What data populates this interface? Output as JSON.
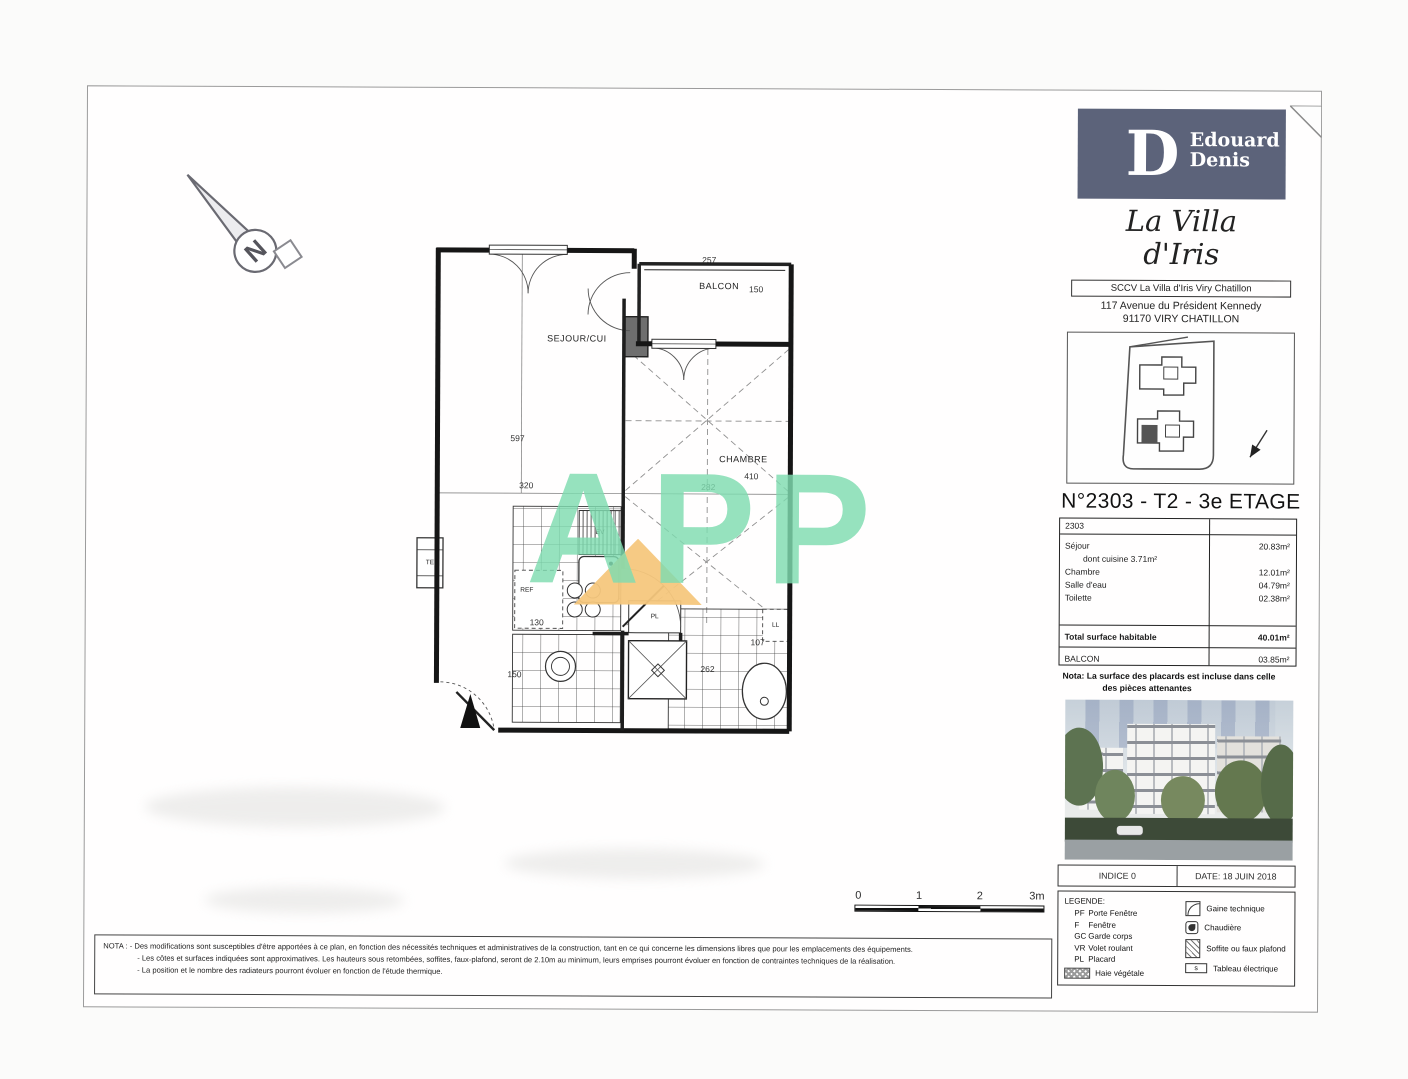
{
  "colors": {
    "brand": "#5c637a",
    "wm_green": "#7fdcb0",
    "wm_orange": "#f6c77d"
  },
  "north": {
    "label": "N"
  },
  "plan": {
    "rooms": {
      "sejour": "SEJOUR/CUI",
      "balcon": "BALCON",
      "chambre": "CHAMBRE"
    },
    "fixtures": {
      "te": "TE",
      "ev": "EV",
      "ref": "REF",
      "pl": "PL",
      "ll": "LL"
    },
    "dims": {
      "balcon_w": "257",
      "balcon_d": "150",
      "sejour_h": "597",
      "sejour_w": "320",
      "chambre_h": "410",
      "chambre_w": "282",
      "kitchen_w": "130",
      "entry_w": "150",
      "bath_w": "262",
      "bath_d": "107"
    }
  },
  "watermark": {
    "text": "APP"
  },
  "scalebar": {
    "ticks": [
      "0",
      "1",
      "2",
      "3m"
    ]
  },
  "nota_bottom": {
    "line1": "NOTA : - Des modifications sont susceptibles d'être apportées à ce plan, en fonction des nécessités techniques et administratives de la construction, tant en ce qui concerne les dimensions libres que pour les emplacements des équipements.",
    "line2": "- Les côtes et surfaces indiquées sont approximatives. Les hauteurs sous retombées, soffites, faux-plafond, seront de 2.10m au minimum, leurs emprises pourront évoluer en fonction de contraintes techniques de la réalisation.",
    "line3": "- La position et le nombre des radiateurs pourront évoluer en fonction de l'étude thermique."
  },
  "titleblock": {
    "logo": {
      "initial": "D",
      "brand_line1": "Edouard",
      "brand_line2": "Denis"
    },
    "project": {
      "line1": "La Villa",
      "line2": "d'Iris"
    },
    "company": "SCCV La Villa d'Iris Viry Chatillon",
    "address1": "117 Avenue du Président Kennedy",
    "address2": "91170 VIRY CHATILLON",
    "unit_title": "N°2303 - T2 - 3e ETAGE",
    "table": {
      "unit": "2303",
      "rows": [
        {
          "label": "Séjour",
          "value": "20.83m²"
        },
        {
          "label": "dont cuisine 3.71m²",
          "value": ""
        },
        {
          "label": "Chambre",
          "value": "12.01m²"
        },
        {
          "label": "Salle d'eau",
          "value": "04.79m²"
        },
        {
          "label": "Toilette",
          "value": "02.38m²"
        }
      ],
      "total_label": "Total surface habitable",
      "total_value": "40.01m²",
      "balcony_label": "BALCON",
      "balcony_value": "03.85m²"
    },
    "nota_line1": "Nota: La surface des placards est incluse dans celle",
    "nota_line2": "des pièces attenantes",
    "indice": "INDICE 0",
    "date": "DATE: 18 JUIN 2018",
    "legend": {
      "title": "LEGENDE:",
      "abbrevs": [
        {
          "abbr": "PF",
          "label": "Porte Fenêtre"
        },
        {
          "abbr": "F",
          "label": "Fenêtre"
        },
        {
          "abbr": "GC",
          "label": "Garde corps"
        },
        {
          "abbr": "VR",
          "label": "Volet roulant"
        },
        {
          "abbr": "PL",
          "label": "Placard"
        }
      ],
      "haie_label": "Haie végétale",
      "symbols": [
        {
          "label": "Gaine technique"
        },
        {
          "label": "Chaudière"
        },
        {
          "label": "Soffite ou faux plafond"
        },
        {
          "label": "Tableau électrique"
        }
      ],
      "electrical_glyph": "s"
    }
  }
}
